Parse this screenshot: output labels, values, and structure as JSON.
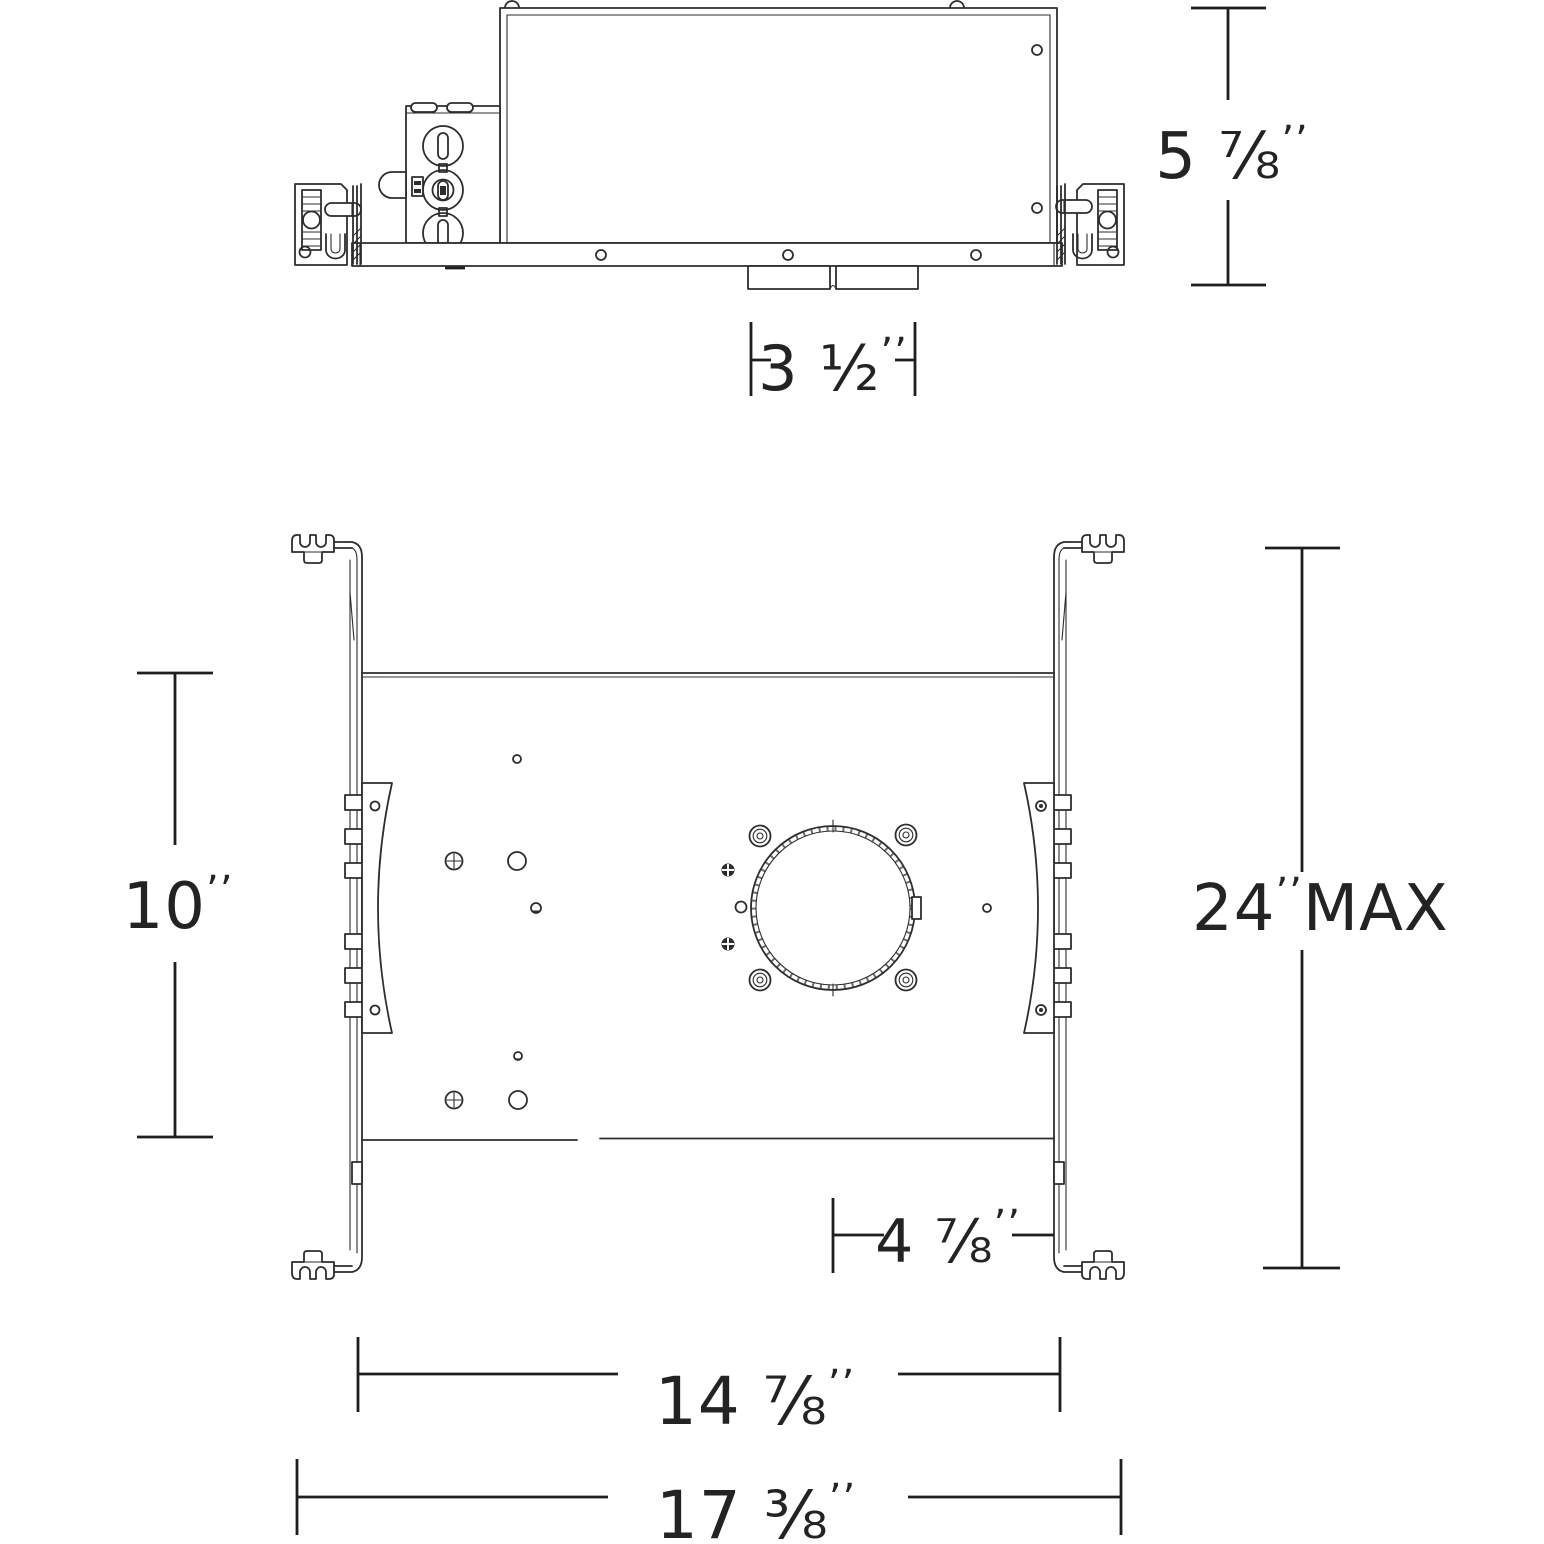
{
  "drawing": {
    "type": "recessed-housing-spec-drawing",
    "views": [
      "side-elevation",
      "plan-view"
    ]
  },
  "dimensions": {
    "housing_height": {
      "value": "5 ⅞",
      "unit": "’’"
    },
    "driver_box_width": {
      "value": "3 ½",
      "unit": "’’"
    },
    "pan_height": {
      "value": "10",
      "unit": "’’"
    },
    "hanger_bar_max_extension": {
      "value": "24",
      "unit": "’’",
      "suffix": "MAX"
    },
    "aperture_to_bar": {
      "value": "4 ⅞",
      "unit": "’’"
    },
    "pan_width": {
      "value": "14 ⅞",
      "unit": "’’"
    },
    "overall_width": {
      "value": "17 ⅜",
      "unit": "’’"
    }
  },
  "colors": {
    "line": "#2d2d2d",
    "dimension": "#1e1e1e",
    "background": "#ffffff"
  }
}
